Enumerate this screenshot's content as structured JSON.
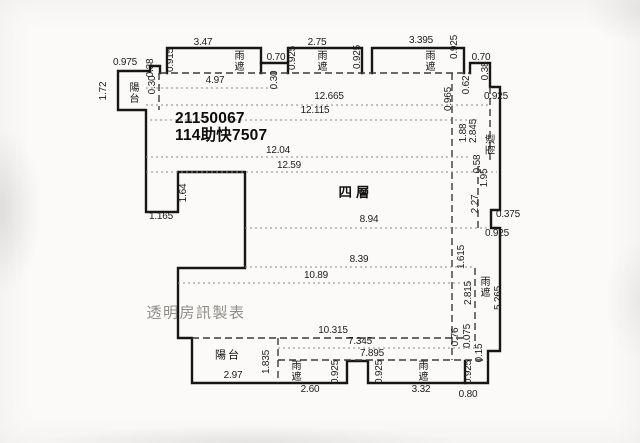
{
  "document": {
    "kind": "floor-plan",
    "floor_label": "四層",
    "id_lines": [
      "21150067",
      "114助快7507"
    ],
    "watermark": "透明房訊製表"
  },
  "colors": {
    "wall_line": "#161616",
    "dashed_line": "#3a3a3a",
    "dimension_line": "#8a8a88",
    "dimension_text": "#1c1c1c",
    "watermark_text": "#8f8d8a",
    "background": "#fbfaf8"
  },
  "annotations": [
    {
      "text": "0.975",
      "x": 125,
      "y": 63,
      "kind": "dim"
    },
    {
      "text": "1.72",
      "x": 104,
      "y": 91,
      "kind": "dimr"
    },
    {
      "text": "陽台",
      "x": 132,
      "y": 93,
      "kind": "roomv"
    },
    {
      "text": "0.38",
      "x": 151,
      "y": 68,
      "kind": "dimr"
    },
    {
      "text": "0.30",
      "x": 153,
      "y": 85,
      "kind": "dimr"
    },
    {
      "text": "0.915",
      "x": 171,
      "y": 60,
      "kind": "dimr"
    },
    {
      "text": "3.47",
      "x": 203,
      "y": 43,
      "kind": "dim"
    },
    {
      "text": "雨遮",
      "x": 237,
      "y": 61,
      "kind": "roomv"
    },
    {
      "text": "4.97",
      "x": 215,
      "y": 81,
      "kind": "dim"
    },
    {
      "text": "0.70",
      "x": 276,
      "y": 58,
      "kind": "dim"
    },
    {
      "text": "0.30",
      "x": 275,
      "y": 80,
      "kind": "dimr"
    },
    {
      "text": "2.75",
      "x": 317,
      "y": 43,
      "kind": "dim"
    },
    {
      "text": "0.925",
      "x": 293,
      "y": 58,
      "kind": "dimr"
    },
    {
      "text": "雨遮",
      "x": 320,
      "y": 61,
      "kind": "roomv"
    },
    {
      "text": "0.925",
      "x": 358,
      "y": 57,
      "kind": "dimr"
    },
    {
      "text": "3.395",
      "x": 421,
      "y": 41,
      "kind": "dim"
    },
    {
      "text": "雨遮",
      "x": 428,
      "y": 61,
      "kind": "roomv"
    },
    {
      "text": "0.925",
      "x": 455,
      "y": 47,
      "kind": "dimr"
    },
    {
      "text": "0.70",
      "x": 481,
      "y": 58,
      "kind": "dim"
    },
    {
      "text": "0.38",
      "x": 486,
      "y": 71,
      "kind": "dimr"
    },
    {
      "text": "0.62",
      "x": 467,
      "y": 85,
      "kind": "dimr"
    },
    {
      "text": "0.965",
      "x": 449,
      "y": 99,
      "kind": "dimr"
    },
    {
      "text": "0.925",
      "x": 496,
      "y": 97,
      "kind": "dim"
    },
    {
      "text": "12.665",
      "x": 329,
      "y": 97,
      "kind": "dim"
    },
    {
      "text": "12.115",
      "x": 315,
      "y": 111,
      "kind": "dim"
    },
    {
      "text": "1.88",
      "x": 464,
      "y": 133,
      "kind": "dimr"
    },
    {
      "text": "2.845",
      "x": 474,
      "y": 131,
      "kind": "dimr"
    },
    {
      "text": "雨遮",
      "x": 492,
      "y": 144,
      "kind": "roomr"
    },
    {
      "text": "12.04",
      "x": 278,
      "y": 151,
      "kind": "dim"
    },
    {
      "text": "12.59",
      "x": 289,
      "y": 166,
      "kind": "dim"
    },
    {
      "text": "0.58",
      "x": 478,
      "y": 164,
      "kind": "dimr"
    },
    {
      "text": "1.95",
      "x": 485,
      "y": 178,
      "kind": "dimr"
    },
    {
      "text": "1.64",
      "x": 184,
      "y": 193,
      "kind": "dimr"
    },
    {
      "text": "1.165",
      "x": 161,
      "y": 217,
      "kind": "dim"
    },
    {
      "text": "2.27",
      "x": 476,
      "y": 204,
      "kind": "dimr"
    },
    {
      "text": "0.375",
      "x": 508,
      "y": 215,
      "kind": "dim"
    },
    {
      "text": "0.925",
      "x": 497,
      "y": 234,
      "kind": "dim"
    },
    {
      "text": "8.94",
      "x": 369,
      "y": 220,
      "kind": "dim"
    },
    {
      "text": "1.615",
      "x": 462,
      "y": 257,
      "kind": "dimr"
    },
    {
      "text": "8.39",
      "x": 359,
      "y": 260,
      "kind": "dim"
    },
    {
      "text": "10.89",
      "x": 316,
      "y": 276,
      "kind": "dim"
    },
    {
      "text": "2.815",
      "x": 469,
      "y": 293,
      "kind": "dimr"
    },
    {
      "text": "雨遮",
      "x": 483,
      "y": 287,
      "kind": "roomv"
    },
    {
      "text": "5.265",
      "x": 499,
      "y": 298,
      "kind": "dimr"
    },
    {
      "text": "10.315",
      "x": 333,
      "y": 331,
      "kind": "dim"
    },
    {
      "text": "7.345",
      "x": 360,
      "y": 342,
      "kind": "dim"
    },
    {
      "text": "7.895",
      "x": 372,
      "y": 354,
      "kind": "dim"
    },
    {
      "text": "0.76",
      "x": 456,
      "y": 337,
      "kind": "dimr"
    },
    {
      "text": "0.075",
      "x": 468,
      "y": 336,
      "kind": "dimr"
    },
    {
      "text": "0.15",
      "x": 480,
      "y": 353,
      "kind": "dimr"
    },
    {
      "text": "0.925",
      "x": 469,
      "y": 372,
      "kind": "dimr"
    },
    {
      "text": "0.80",
      "x": 468,
      "y": 395,
      "kind": "dim"
    },
    {
      "text": "陽台",
      "x": 228,
      "y": 356,
      "kind": "room"
    },
    {
      "text": "1.835",
      "x": 267,
      "y": 362,
      "kind": "dimr"
    },
    {
      "text": "2.97",
      "x": 233,
      "y": 376,
      "kind": "dim"
    },
    {
      "text": "雨遮",
      "x": 294,
      "y": 371,
      "kind": "roomv"
    },
    {
      "text": "0.925",
      "x": 336,
      "y": 372,
      "kind": "dimr"
    },
    {
      "text": "2.60",
      "x": 310,
      "y": 390,
      "kind": "dim"
    },
    {
      "text": "0.925",
      "x": 380,
      "y": 372,
      "kind": "dimr"
    },
    {
      "text": "雨遮",
      "x": 421,
      "y": 371,
      "kind": "roomv"
    },
    {
      "text": "3.32",
      "x": 421,
      "y": 390,
      "kind": "dim"
    }
  ]
}
